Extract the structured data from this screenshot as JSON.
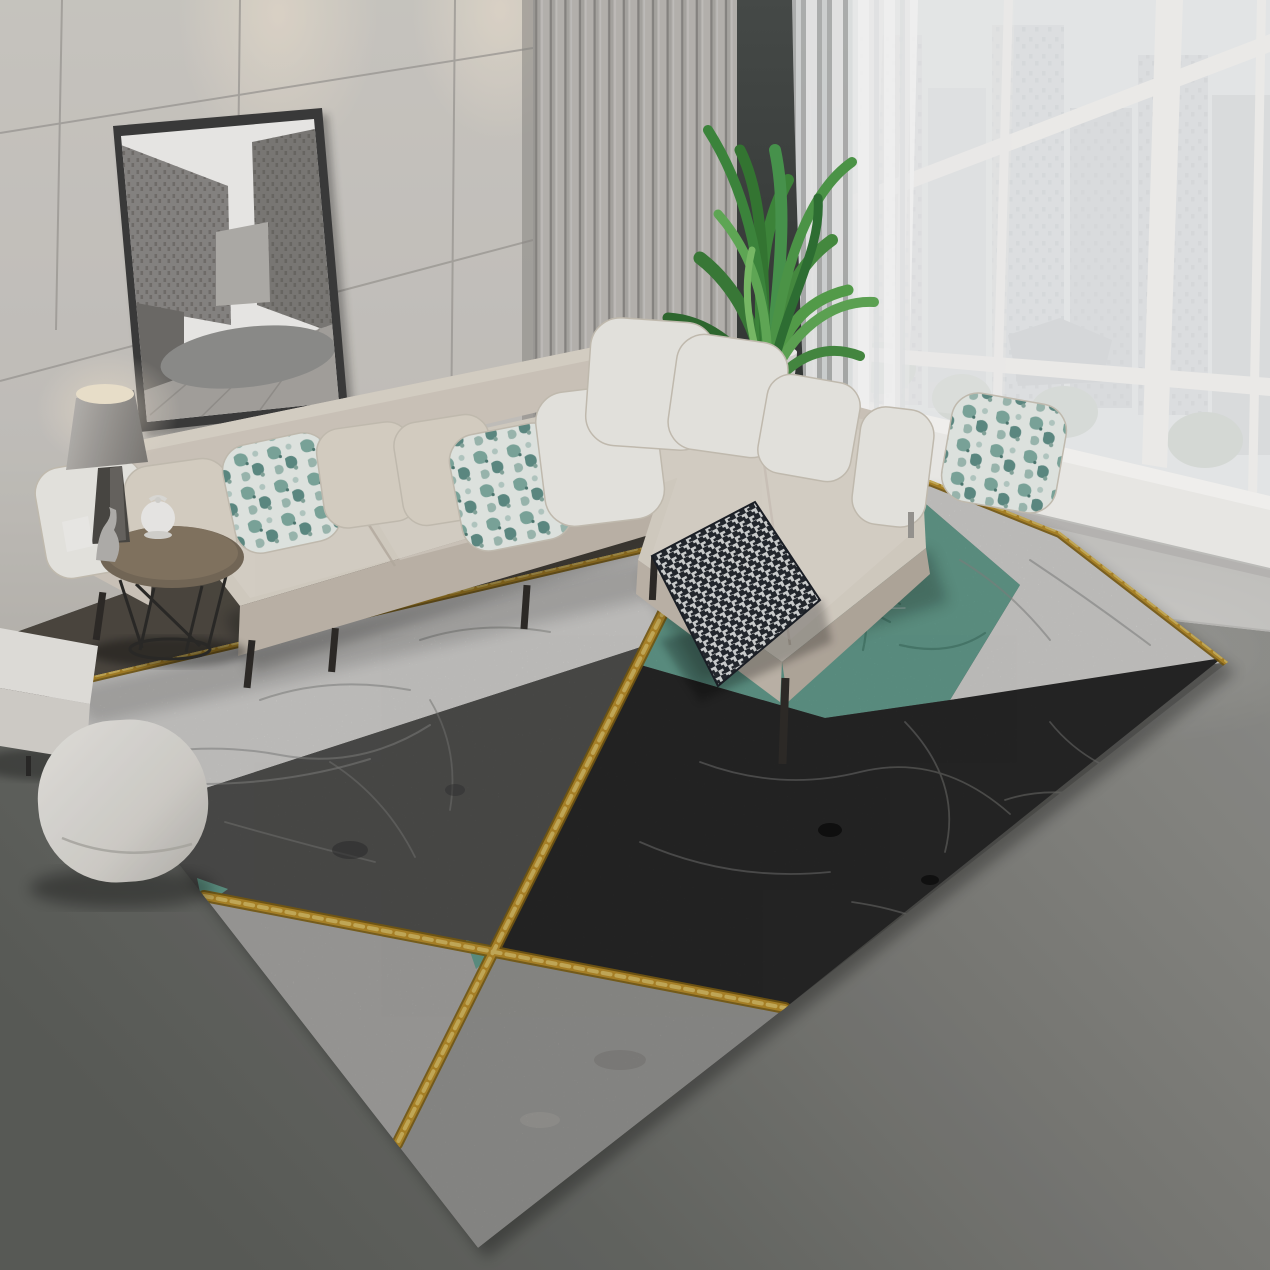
{
  "scene": {
    "kind": "product-photograph",
    "subject": "Geometric marble-pattern area rug with gold lines in a modern living room",
    "setting": "corner living room with panel wall, slat wall, floor-to-ceiling city windows"
  },
  "objects": {
    "framed_artwork": "black-and-white city street photograph in thin dark frame, leaning tilt on wall",
    "wall_spotlights": "two warm ceiling spotlight glows on back wall",
    "table_lamp": "gray cone-shade table lamp, lit",
    "side_table": "round wood-top side table with thin black metal legs",
    "teapot": "small white teapot on side table",
    "figurine": "small silver figurine on side table",
    "sectional_sofa": "beige L-shaped sectional with chaise",
    "pillows": [
      "white",
      "cream",
      "teal floral",
      "cream",
      "cream",
      "teal floral",
      "white",
      "white corner",
      "white corner",
      "white",
      "white bolster",
      "teal floral"
    ],
    "houndstooth_cushion": "dark checkered cushion leaning at sofa corner on rug",
    "potted_plant": "tall green leafy plant in white pot behind sofa",
    "dark_accent_panel": "charcoal panel between slat wall and window",
    "sheer_curtain": "white sheer curtain at window left edge",
    "window": "white-framed floor-to-ceiling window grid with pale high-rise city view",
    "rug_sections": [
      "white marble band",
      "teal marble triangle",
      "white marble corner",
      "black marble field",
      "dark gray marble",
      "silver gray triangle",
      "light gray triangle",
      "gold glitter dividing lines",
      "small teal accent slivers"
    ],
    "cube_ottoman": "white cube bench at left edge",
    "round_pouf": "white rounded pouf on floor"
  },
  "palette": {
    "wall": "#cbc8c3",
    "slat_wall": "#bdbab6",
    "dark_panel": "#3d4140",
    "window_city": "#e9eaec",
    "mullion": "#f6f5f3",
    "sill": "#f3f2ef",
    "wall_below_window": "#cac9c6",
    "curtain": "#f4f4f3",
    "floor": "#777874",
    "floor_dark_strip": "#4a443d",
    "rug_white": "#e9e8e5",
    "rug_teal": "#6fae9d",
    "rug_black": "#2b2b2b",
    "rug_darkgray": "#585856",
    "rug_gray": "#a5a4a1",
    "rug_silver": "#b9b8b5",
    "gold": "#cf9f2f",
    "gold_dark": "#8f6c14",
    "gold_light": "#f0d06c",
    "sofa_body": "#d2cabf",
    "sofa_seat": "#d9d2c7",
    "sofa_front": "#c1b8ac",
    "pillow_white": "#edebe6",
    "pillow_cream": "#ddd5c9",
    "floral_base": "#e7ece8",
    "houndstooth_dark": "#23272e",
    "plant_green": "#3f8a3c",
    "pot": "#ececea",
    "frame": "#3b3b3b",
    "photo_sky": "#f1f0ee",
    "photo_street": "#a8a5a1",
    "photo_blob": "#90908e",
    "lamp_shade": "#a09d99",
    "table_wood": "#776a59",
    "ottoman": "#e7e5e1",
    "pouf": "#d9d7d2"
  }
}
